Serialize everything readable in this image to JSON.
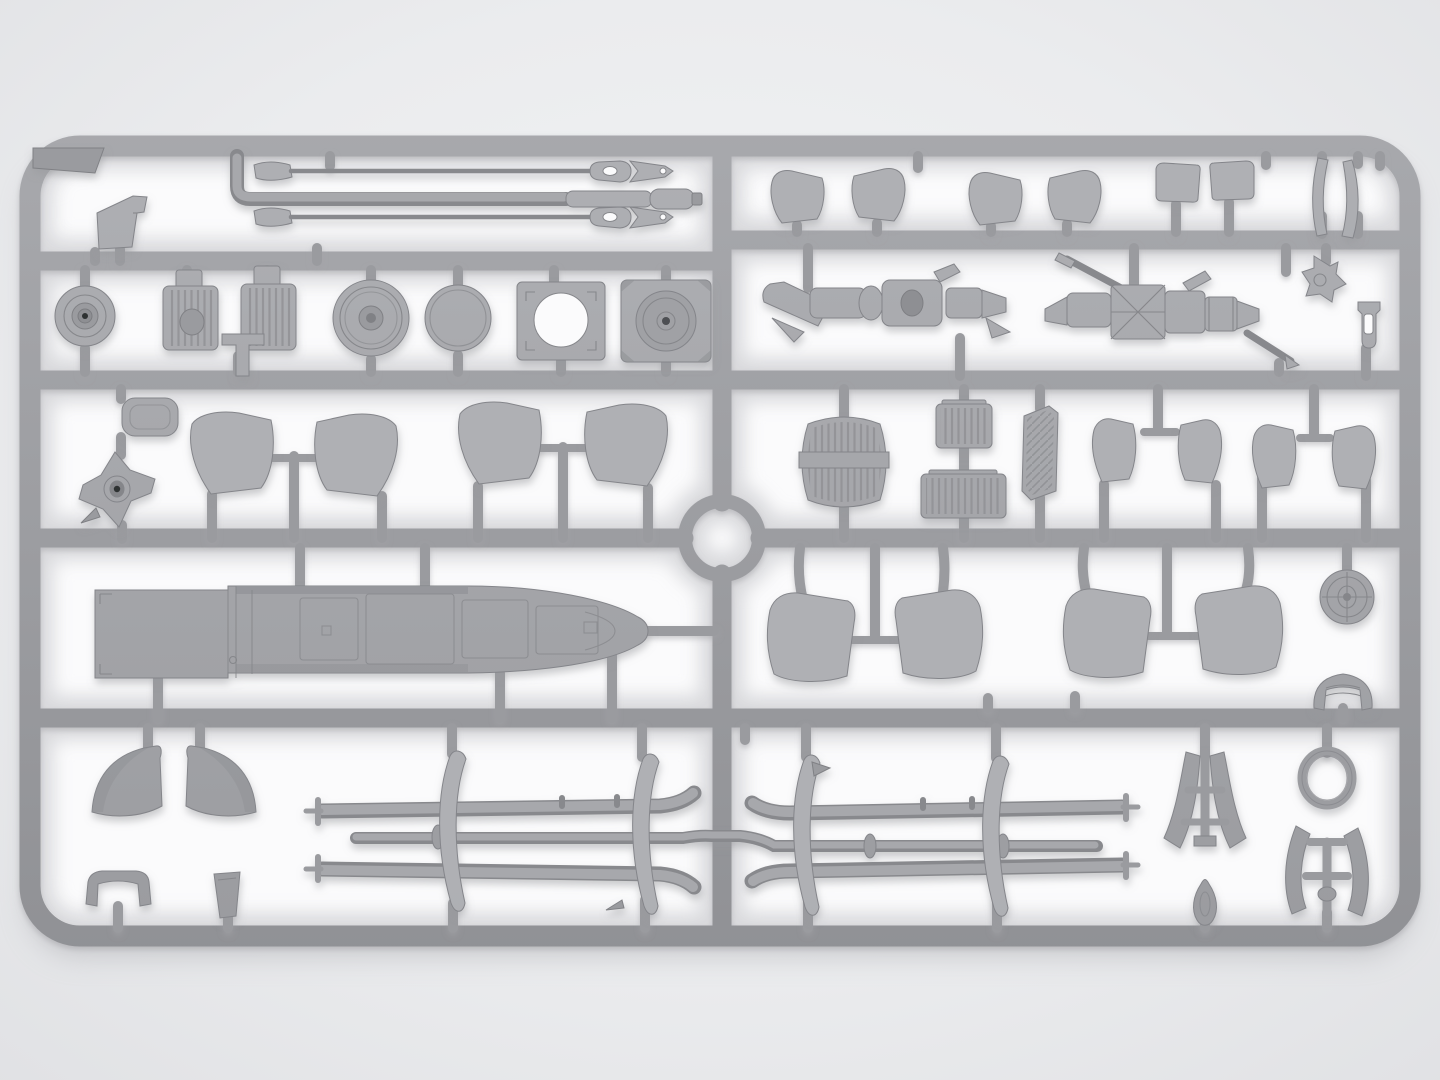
{
  "meta": {
    "title": "Gray injection-molded model kit sprue with helicopter parts, photographed top-down on a light studio background",
    "object": "plastic model parts tree (sprue)",
    "material": "light gray styrene"
  },
  "scene": {
    "layout": "rectangular runner frame, central vertical runner with molding ring, four horizontal rails forming part rows",
    "colors": {
      "bg_outer": "#e3e4e6",
      "bg_inner": "#f2f3f4",
      "cell": "#fbfbfc",
      "sprue": "#9a9b9f",
      "sprue_dark": "#8d8e92",
      "part": "#a3a4a8",
      "part_light": "#b0b1b5",
      "detail": "#86878b",
      "hole": "#4e4f52",
      "hole_deep": "#2f3032",
      "shadow": "#aeafb3",
      "ao": "#d5d6d9"
    }
  },
  "parts": [
    {
      "name": "corner-tab-plate",
      "qty": 1
    },
    {
      "name": "angled-mount-plate",
      "qty": 1
    },
    {
      "name": "bent-fuel-line",
      "qty": 1
    },
    {
      "name": "antenna-rod-with-arrow-tip",
      "qty": 2
    },
    {
      "name": "belt-pulley-hub",
      "qty": 1
    },
    {
      "name": "ribbed-engine-block",
      "qty": 2
    },
    {
      "name": "main-wheel",
      "qty": 1
    },
    {
      "name": "tire-disc",
      "qty": 1
    },
    {
      "name": "mount-plate-with-opening",
      "qty": 1
    },
    {
      "name": "mount-plate-with-hub",
      "qty": 1
    },
    {
      "name": "cabin-window-panel",
      "qty": 6
    },
    {
      "name": "rectangular-hatch-panel",
      "qty": 2
    },
    {
      "name": "curved-canopy-strip",
      "qty": 2
    },
    {
      "name": "engine-gearbox-assembly",
      "qty": 2
    },
    {
      "name": "cross-bracket",
      "qty": 1
    },
    {
      "name": "fork-bracket",
      "qty": 1
    },
    {
      "name": "seat-cushion",
      "qty": 1
    },
    {
      "name": "rotor-hub-star",
      "qty": 1
    },
    {
      "name": "cabin-door-panel",
      "qty": 8
    },
    {
      "name": "radiator-core",
      "qty": 1
    },
    {
      "name": "ribbed-seat-pan",
      "qty": 2
    },
    {
      "name": "louvered-vent-panel",
      "qty": 1
    },
    {
      "name": "fuselage-spine-panel",
      "qty": 1
    },
    {
      "name": "cargo-door",
      "qty": 4
    },
    {
      "name": "spoked-wheel-disc",
      "qty": 1
    },
    {
      "name": "instrument-shroud",
      "qty": 1
    },
    {
      "name": "nose-cowl-half",
      "qty": 2
    },
    {
      "name": "saddle-clamp",
      "qty": 1
    },
    {
      "name": "wedge-block",
      "qty": 1
    },
    {
      "name": "landing-ski",
      "qty": 4
    },
    {
      "name": "skid-cross-tube",
      "qty": 2
    },
    {
      "name": "curved-support-blade",
      "qty": 4
    },
    {
      "name": "tail-fin-ladder-frame",
      "qty": 1
    },
    {
      "name": "sealing-ring",
      "qty": 1
    },
    {
      "name": "horn-fairing-frame",
      "qty": 1
    },
    {
      "name": "teardrop-fairing",
      "qty": 1
    }
  ]
}
